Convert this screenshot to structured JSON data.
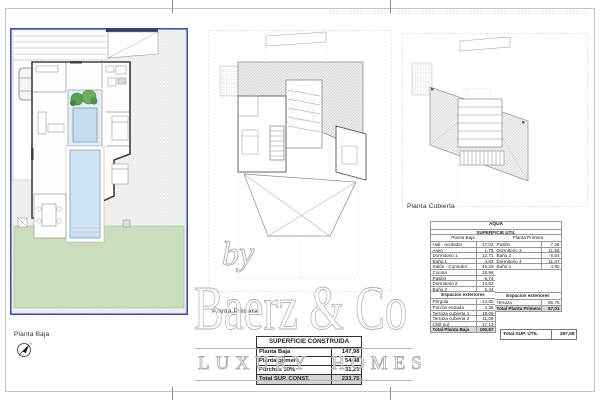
{
  "colors": {
    "frame_blue": "#3647a5",
    "pool_blue": "#c5dcee",
    "garden_green": "#cfe0c2",
    "watermark_gray": "#b5b5b5"
  },
  "brand": {
    "by": "by",
    "name": "Baerz & Co",
    "tagline": "LUXURY HOMES"
  },
  "plans": {
    "planta_baja_label": "Planta Baja",
    "planta_primera_label": "Planta Primera",
    "planta_cubierta_label": "Planta Cubierta"
  },
  "superficie_construida": {
    "title": "SUPERFICIE CONSTRUIDA",
    "rows": [
      {
        "label": "Planta Baja",
        "value": "147,98"
      },
      {
        "label": "Planta primera",
        "value": "54,48"
      },
      {
        "label": "Porches 50%",
        "value": "31,29"
      }
    ],
    "total": {
      "label": "Total SUP. CONST.",
      "value": "233,75"
    }
  },
  "superficie_util": {
    "title": "AQUA",
    "subtitle": "SUPERFICIE ÚTIL",
    "left": {
      "header": "Planta Baja",
      "rows": [
        {
          "label": "Hall - recibidor",
          "value": "17,02"
        },
        {
          "label": "Aseo",
          "value": "1,75"
        },
        {
          "label": "Dormitorio 1",
          "value": "12,71"
        },
        {
          "label": "Baño 1",
          "value": "4,83"
        },
        {
          "label": "Salón - Comedor",
          "value": "45,29"
        },
        {
          "label": "Cocina",
          "value": "18,98"
        },
        {
          "label": "Pasillo",
          "value": "5,74"
        },
        {
          "label": "Dormitorio 2",
          "value": "14,52"
        },
        {
          "label": "Baño 2",
          "value": "6,44"
        }
      ],
      "ext_header": "Espacios exteriores",
      "ext": [
        {
          "label": "Pérgola",
          "value": "14,65"
        },
        {
          "label": "Porche entrada",
          "value": "4,36"
        },
        {
          "label": "Terraza cubierta 1",
          "value": "18,69"
        },
        {
          "label": "Terraza cubierta 2",
          "value": "11,06"
        },
        {
          "label": "Chill out",
          "value": "17,13"
        }
      ],
      "total": {
        "label": "Total Planta Baja",
        "value": "190,57"
      }
    },
    "right": {
      "header": "Planta Primera",
      "rows": [
        {
          "label": "Pasillo",
          "value": "7,28"
        },
        {
          "label": "Dormitorio 3",
          "value": "11,58"
        },
        {
          "label": "Baño 3",
          "value": "5,54"
        },
        {
          "label": "Dormitorio 4",
          "value": "11,37"
        },
        {
          "label": "Baño 4",
          "value": "4,90"
        }
      ],
      "ext_header": "Espacios exteriores",
      "ext": [
        {
          "label": "Terraza",
          "value": "55,76"
        }
      ],
      "total": {
        "label": "Total Planta Primera",
        "value": "97,01"
      }
    },
    "grand_total": {
      "label": "Total SUP. ÚTIL",
      "value": "287,58"
    }
  }
}
